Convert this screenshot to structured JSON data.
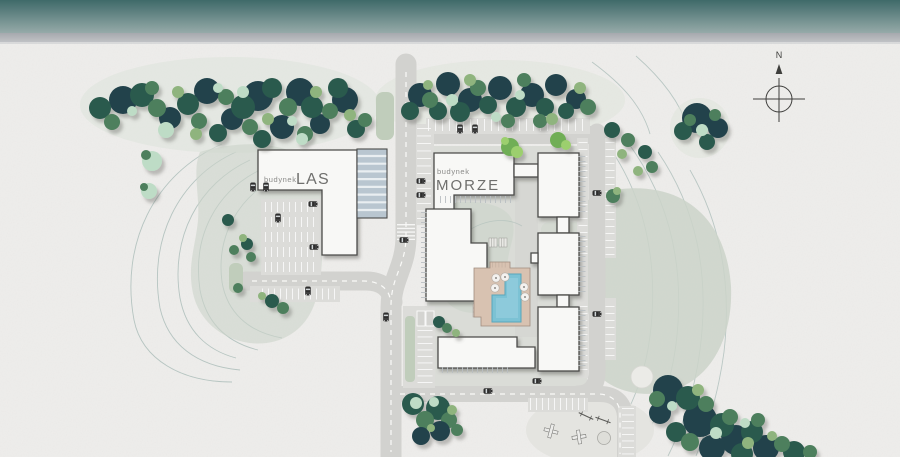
{
  "labels": {
    "las": {
      "prefix": "budynek",
      "name": "LAS"
    },
    "morze": {
      "prefix": "budynek",
      "name": "MORZE"
    },
    "compass": "N"
  },
  "colors": {
    "sea_top": "#3f6a69",
    "sea_bottom": "#96aaa9",
    "shore_top": "#a6a9ae",
    "shore_bottom": "#c0c2c5",
    "shore_line": "#d9dadb",
    "ground": "#eeedeb",
    "lawn": "#cbd4c9",
    "lawn_light": "#dde3da",
    "hedge": "#c0cdbb",
    "courtyard": "#dadcd7",
    "path": "#d6d7d3",
    "road": "#d2d2cf",
    "road_line": "#fafaf8",
    "parking": "#dcdcd9",
    "tick": "#ffffff",
    "building_fill": "#f8f8f6",
    "building_stroke": "#4b4b49",
    "comb": "#b9bfc2",
    "stripe_base": "#b9c6d0",
    "stripe_line": "#e9eef1",
    "deck": "#d8c2b1",
    "deck_edge": "#a08d7f",
    "water": "#7cc2d4",
    "water_edge": "#58a7bc",
    "tree_dark": "#20434b",
    "tree_deep": "#2b5a4e",
    "tree_mid": "#4d7f5d",
    "tree_light": "#8fb47e",
    "tree_mint": "#bedcc6",
    "tree_bright": "#6fae57",
    "tree_bright2": "#9ccf6e",
    "contour": "#a4b8b4",
    "label_small": "#8b8b89",
    "label_big": "#6f6f6d",
    "compass": "#3e3e3c",
    "car_body": "#2e2e2e",
    "playground": "#5b5b58"
  }
}
